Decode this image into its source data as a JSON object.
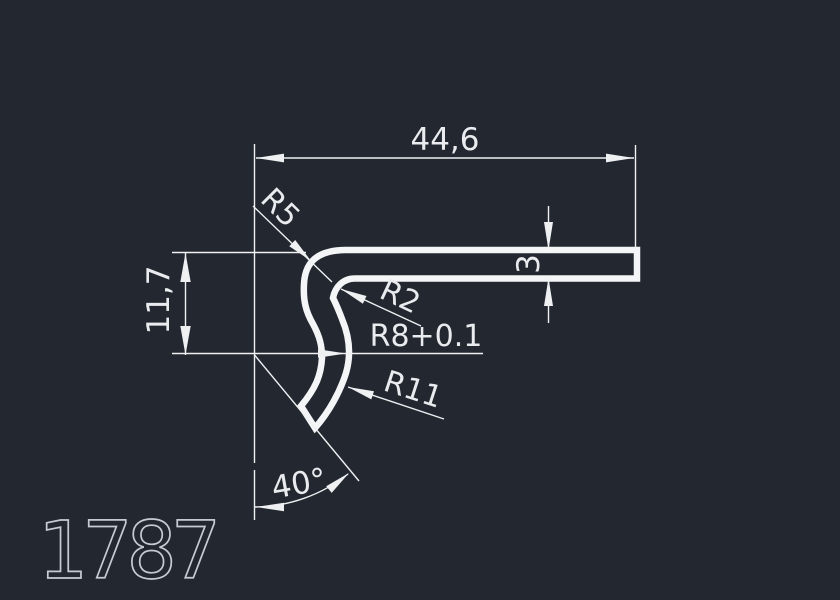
{
  "drawing": {
    "part_label": "1787",
    "labels": {
      "length": "44,6",
      "height": "11,7",
      "thickness": "3",
      "angle": "40°",
      "r5": "R5",
      "r2": "R2",
      "r8": "R8+0.1",
      "r11": "R11"
    },
    "colors": {
      "background": "#232830",
      "line": "#eef0f2",
      "profile": "#f4f5f6",
      "part_label_text": "#c7cbd1"
    }
  }
}
